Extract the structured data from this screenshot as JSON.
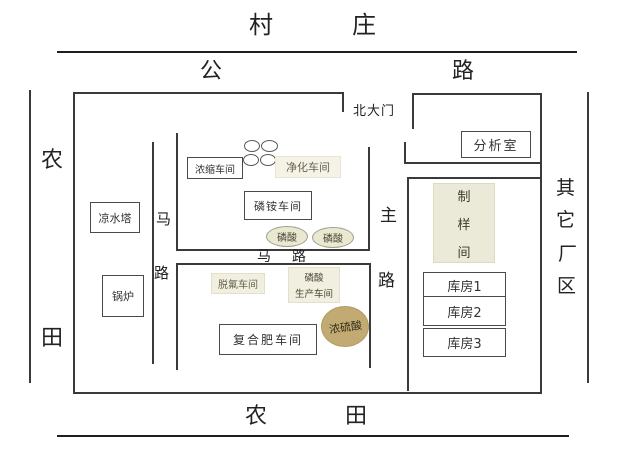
{
  "env": {
    "village": [
      "村",
      "庄"
    ],
    "highway": [
      "公",
      "路"
    ],
    "farmland_left": [
      "农",
      "田"
    ],
    "farmland_bottom": [
      "农",
      "田"
    ],
    "other_factory_area": [
      "其",
      "它",
      "厂",
      "区"
    ]
  },
  "gate": {
    "north_gate": "北大门"
  },
  "rooms": {
    "analysis_room": "分析室",
    "sample_prep_room": [
      "制",
      "样",
      "间"
    ],
    "warehouse_1": "库房1",
    "warehouse_2": "库房2",
    "warehouse_3": "库房3",
    "concentration_workshop": "浓缩车间",
    "purification_workshop": "净化车间",
    "ammonium_phosphate_workshop": "磷铵车间",
    "phosphoric_acid_tank_1": "磷酸",
    "phosphoric_acid_tank_2": "磷酸",
    "cooling_tower": "凉水塔",
    "boiler": "锅炉",
    "defluorination_workshop": "脱氟车间",
    "phosphoric_acid_production_line1": "磷酸",
    "phosphoric_acid_production_line2": "生产车间",
    "concentrated_sulfuric_acid": "浓硫酸",
    "compound_fertilizer_workshop": "复合肥车间"
  },
  "roads": {
    "inner_road_vertical": [
      "马",
      "路"
    ],
    "inner_road_horizontal": [
      "马",
      "路"
    ],
    "main_road": [
      "主",
      "路"
    ]
  },
  "colors": {
    "line": "#3a3a3a",
    "cream_block": "#f1f0e0",
    "acid_ellipse": "#e9e8d0",
    "sulfuric_ellipse": "#c1ab73"
  }
}
